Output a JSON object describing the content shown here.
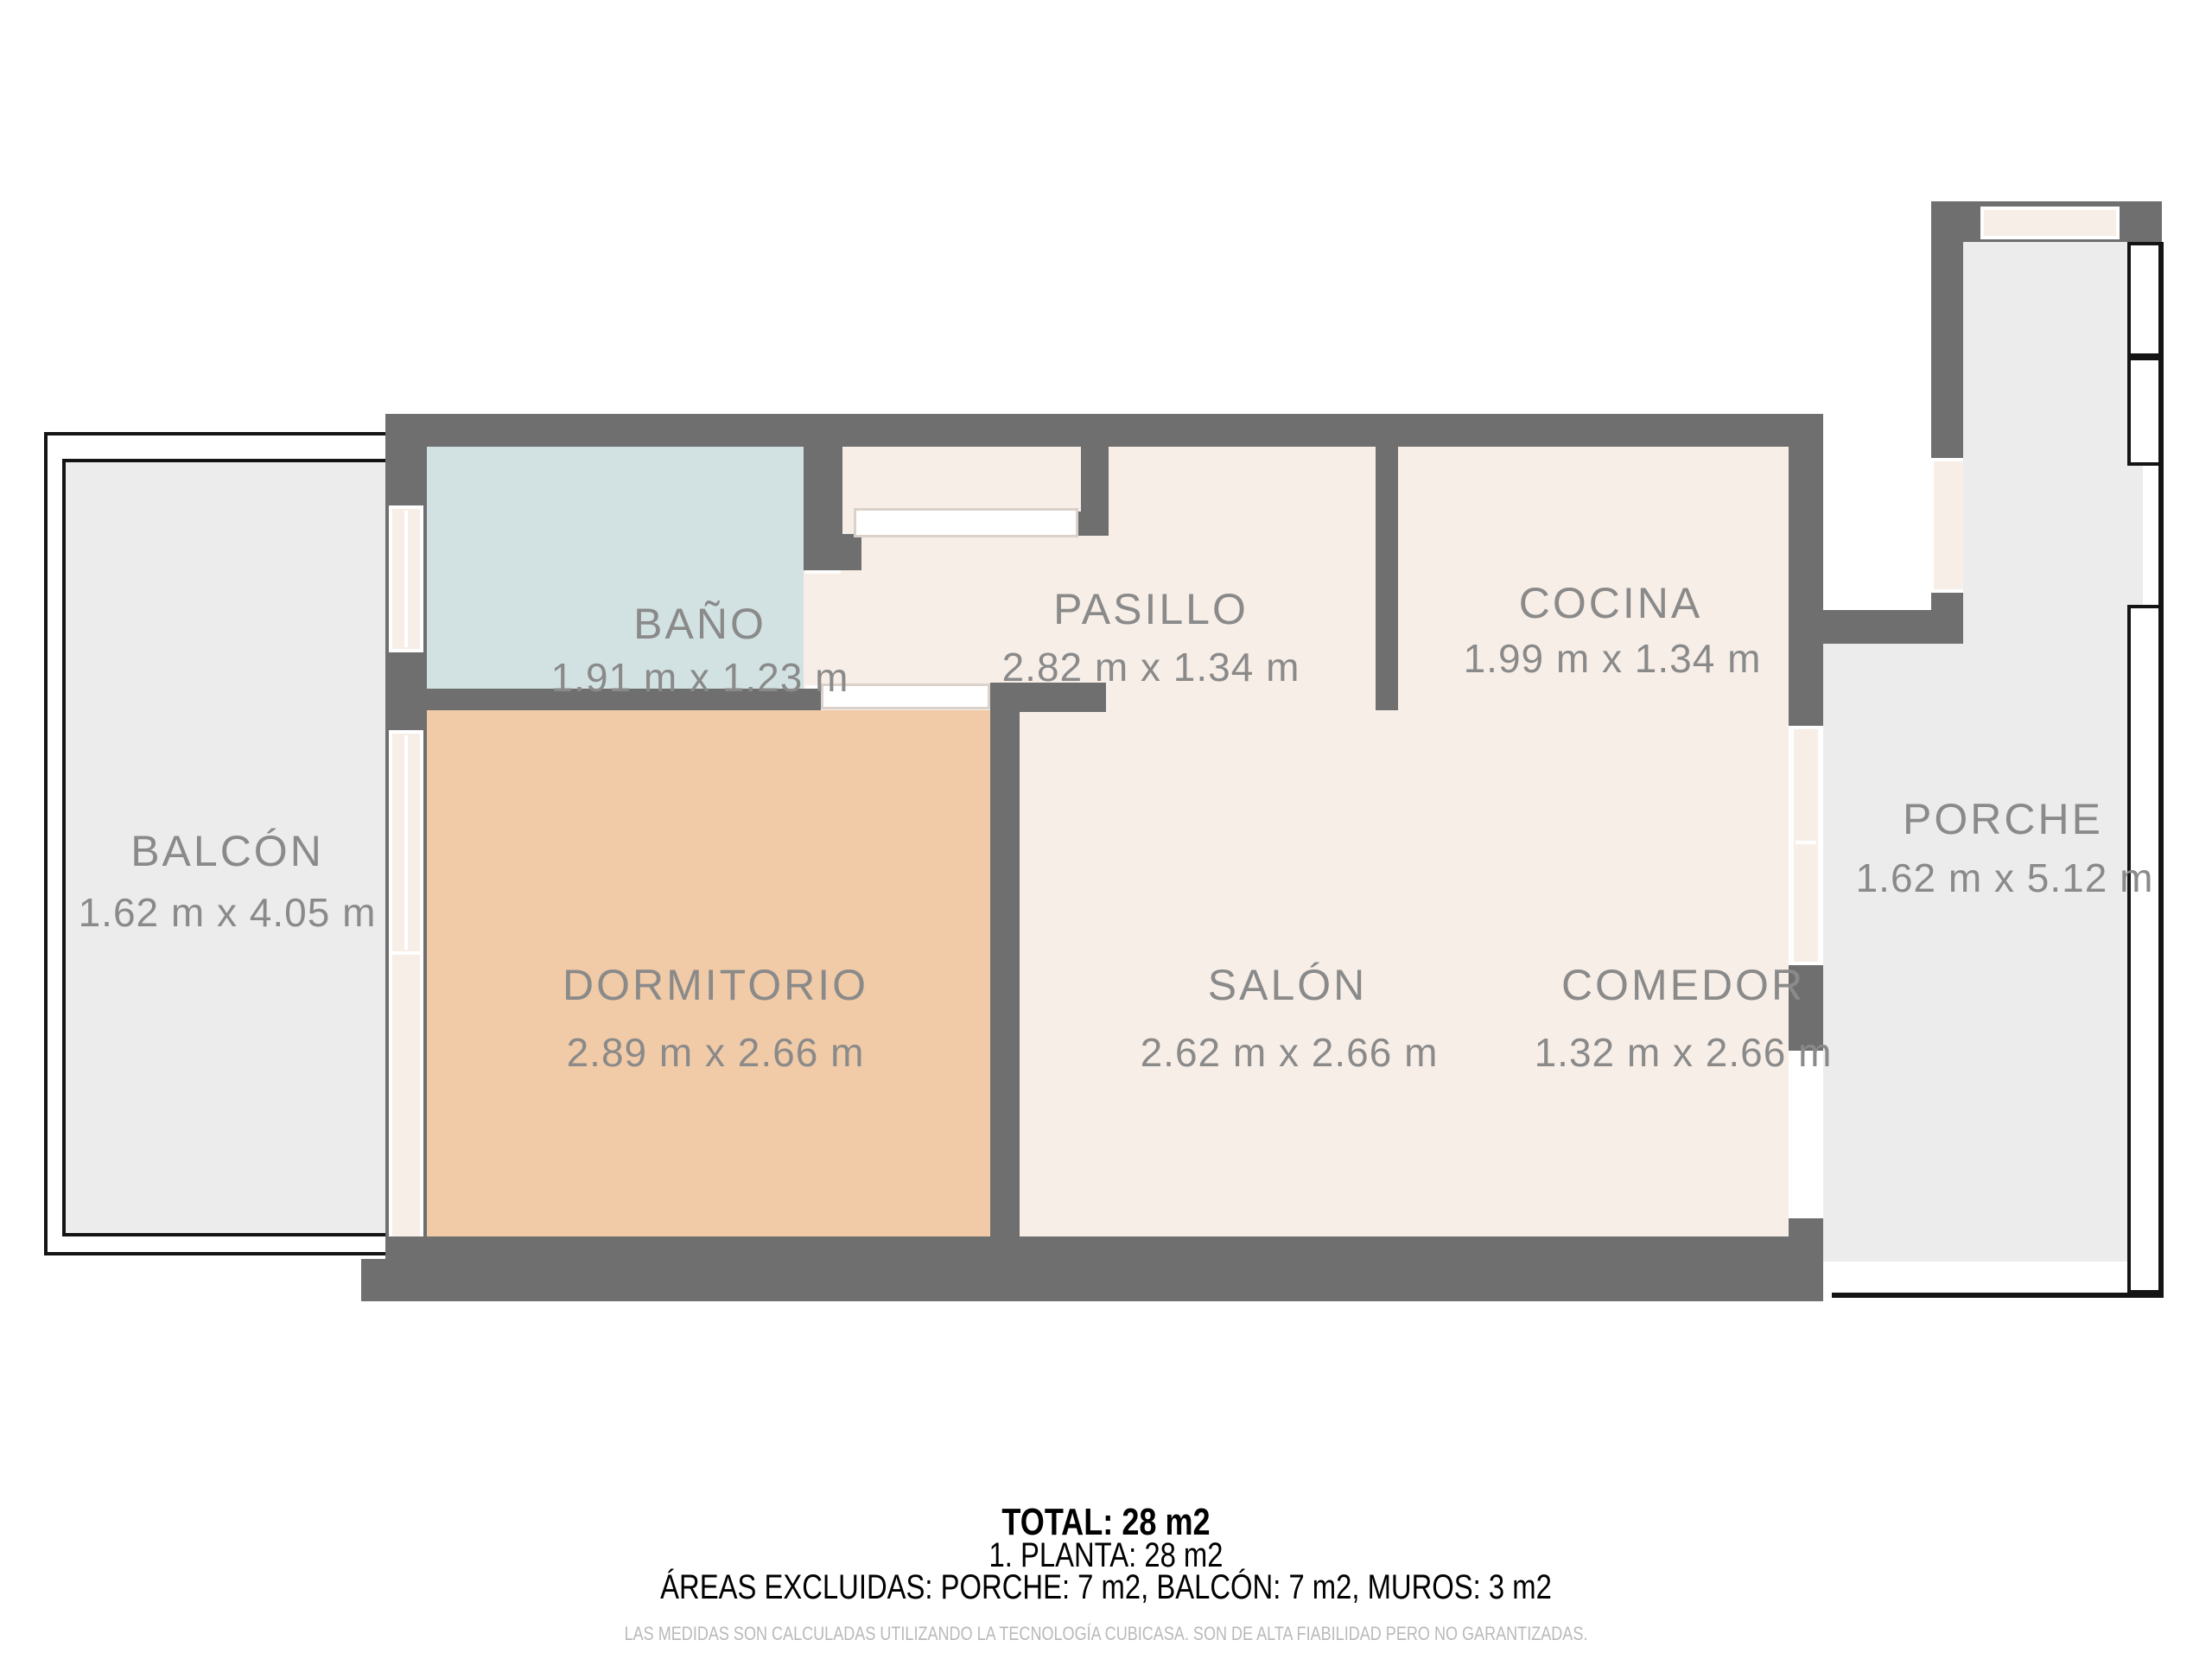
{
  "plan": {
    "rooms": [
      {
        "id": "bano",
        "name": "BAÑO",
        "dimensions": "1.91 m x 1.23 m",
        "floor_color": "#d2e2e2"
      },
      {
        "id": "pasillo",
        "name": "PASILLO",
        "dimensions": "2.82 m x 1.34 m",
        "floor_color": "#f7eee7"
      },
      {
        "id": "cocina",
        "name": "COCINA",
        "dimensions": "1.99 m x 1.34 m",
        "floor_color": "#f7eee7"
      },
      {
        "id": "dormitorio",
        "name": "DORMITORIO",
        "dimensions": "2.89 m x 2.66 m",
        "floor_color": "#f1cba7"
      },
      {
        "id": "salon",
        "name": "SALÓN",
        "dimensions": "2.62 m x 2.66 m",
        "floor_color": "#f7eee7"
      },
      {
        "id": "comedor",
        "name": "COMEDOR",
        "dimensions": "1.32 m x 2.66 m",
        "floor_color": "#f7eee7"
      },
      {
        "id": "balcon",
        "name": "BALCÓN",
        "dimensions": "1.62 m x 4.05 m",
        "floor_color": "#ececec"
      },
      {
        "id": "porche",
        "name": "PORCHE",
        "dimensions": "1.62 m x 5.12 m",
        "floor_color": "#ececec"
      }
    ],
    "colors": {
      "wall": "#6f6f6f",
      "interior_floor": "#f7eee7",
      "outdoor_floor": "#ececec",
      "window_frame": "#ffffff",
      "outline_black": "#141414",
      "label_text": "#8a8a8a"
    }
  },
  "summary": {
    "total": "TOTAL: 28 m2",
    "floor": "1. PLANTA: 28 m2",
    "excluded": "ÁREAS EXCLUIDAS: PORCHE: 7 m2, BALCÓN: 7 m2, MUROS: 3 m2",
    "disclaimer": "LAS MEDIDAS SON CALCULADAS UTILIZANDO LA TECNOLOGÍA CUBICASA. SON DE ALTA FIABILIDAD PERO NO GARANTIZADAS."
  }
}
